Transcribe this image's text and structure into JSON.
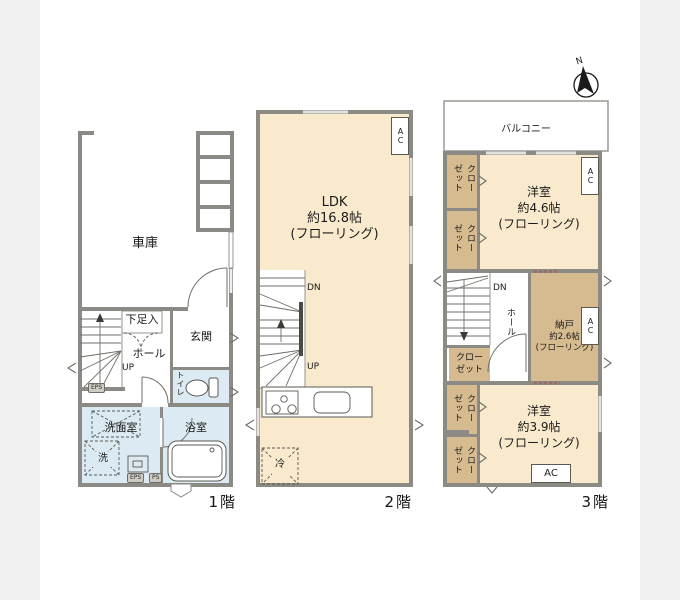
{
  "plan": {
    "compass_label": "N",
    "floor1": {
      "label": "1階",
      "garage": "車庫",
      "shoe_box": "下足入",
      "hall": "ホール",
      "up": "UP",
      "entrance": "玄関",
      "toilet": "トイレ",
      "washroom": "洗面室",
      "washer": "洗",
      "bathroom": "浴室",
      "eps_upper": "EPS",
      "eps_lower": "EPS",
      "ps_lower": "PS"
    },
    "floor2": {
      "label": "2階",
      "ldk_name": "LDK",
      "ldk_size": "約16.8帖",
      "ldk_finish": "(フローリング)",
      "dn": "DN",
      "up": "UP",
      "ac": "AC",
      "fridge": "冷"
    },
    "floor3": {
      "label": "3階",
      "balcony": "バルコニー",
      "closet_a": "クローゼット",
      "closet_b": "クローゼット",
      "closet_mid_line1": "クロー",
      "closet_mid_line2": "ゼット",
      "closet_c": "クローゼット",
      "closet_d": "クローゼット",
      "room_top_name": "洋室",
      "room_top_size": "約4.6帖",
      "room_top_finish": "(フローリング)",
      "ac_top": "AC",
      "hall": "ホール",
      "dn": "DN",
      "storage_name": "納戸",
      "storage_size": "約2.6帖",
      "storage_finish": "(フローリング)",
      "ac_storage": "AC",
      "room_bottom_name": "洋室",
      "room_bottom_size": "約3.9帖",
      "room_bottom_finish": "(フローリング)",
      "ac_bottom": "AC"
    },
    "colors": {
      "wall": "#8b8a84",
      "room_cream": "#faeacd",
      "closet_tan": "#d5bb8f",
      "wet_area_blue": "#dcebf3",
      "background": "#f0f0f0"
    }
  }
}
